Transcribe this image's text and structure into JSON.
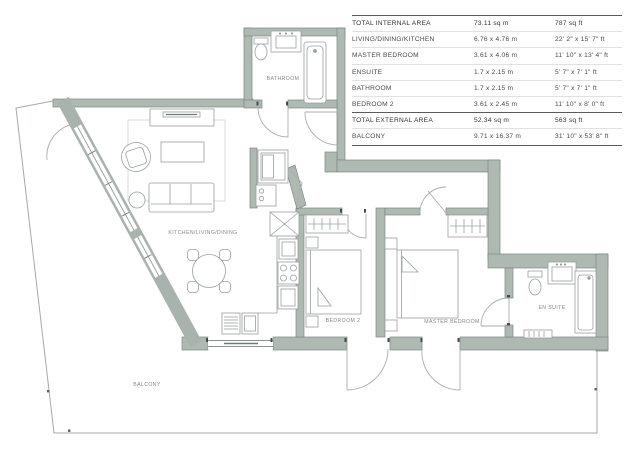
{
  "plan": {
    "rooms": {
      "bathroom": "BATHROOM",
      "kitchen_living_dining": "KITCHEN/LIVING/DINING",
      "bedroom2": "BEDROOM 2",
      "master_bedroom": "MASTER BEDROOM",
      "ensuite": "EN SUITE",
      "balcony": "BALCONY"
    },
    "colors": {
      "wall_fill": "#aeb9b2",
      "wall_stroke": "#7c8983",
      "furniture_line": "#98a09d",
      "door_arc": "#a9afad",
      "balcony_line": "#a3aaa6",
      "label_text": "#83878a"
    }
  },
  "area_table": {
    "rows": [
      {
        "label": "TOTAL INTERNAL AREA",
        "metric": "73.11 sq m",
        "imperial": "787 sq ft",
        "emphasis": true
      },
      {
        "label": "LIVING/DINING/KITCHEN",
        "metric": "6.76 x 4.76 m",
        "imperial": "22' 2\" x 15' 7\" ft",
        "emphasis": false
      },
      {
        "label": "MASTER BEDROOM",
        "metric": "3.61 x 4.06 m",
        "imperial": "11' 10\" x 13' 4\" ft",
        "emphasis": false
      },
      {
        "label": "ENSUITE",
        "metric": "1.7 x 2.15 m",
        "imperial": "5' 7\" x 7' 1\" ft",
        "emphasis": false
      },
      {
        "label": "BATHROOM",
        "metric": "1.7 x 2.15 m",
        "imperial": "5' 7\" x 7' 1\" ft",
        "emphasis": false
      },
      {
        "label": "BEDROOM 2",
        "metric": "3.61 x 2.45 m",
        "imperial": "11' 10\" x 8' 0\" ft",
        "emphasis": false
      },
      {
        "label": "TOTAL EXTERNAL AREA",
        "metric": "52.34 sq m",
        "imperial": "563 sq ft",
        "emphasis": true
      },
      {
        "label": "BALCONY",
        "metric": "9.71 x 16.37 m",
        "imperial": "31' 10\" x 53' 8\" ft",
        "emphasis": false
      }
    ]
  }
}
